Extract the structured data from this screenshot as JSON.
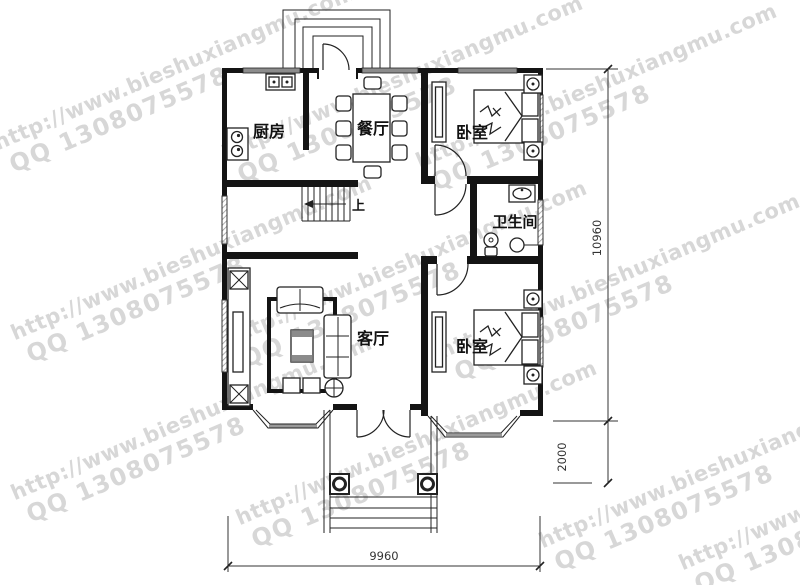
{
  "title": "residential floor plan",
  "watermark": {
    "url": "http://www.bieshuxiangmu.com",
    "qq": "QQ 1308075578"
  },
  "rooms": {
    "kitchen": {
      "label": "厨房"
    },
    "dining": {
      "label": "餐厅"
    },
    "bedroom_top": {
      "label": "卧室"
    },
    "bathroom": {
      "label": "卫生间"
    },
    "living": {
      "label": "客厅"
    },
    "bedroom_bottom": {
      "label": "卧室"
    },
    "stairs": {
      "direction_label": "上"
    }
  },
  "dimensions": {
    "overall_height_mm": "10960",
    "porch_depth_mm": "2000",
    "overall_width_mm": "9960"
  },
  "colors": {
    "wall": "#141414",
    "furniture_line": "#222222",
    "window_gray": "#8c8c8c",
    "dimension_line": "#333333",
    "watermark": "#d7d7d7",
    "background": "#ffffff"
  }
}
